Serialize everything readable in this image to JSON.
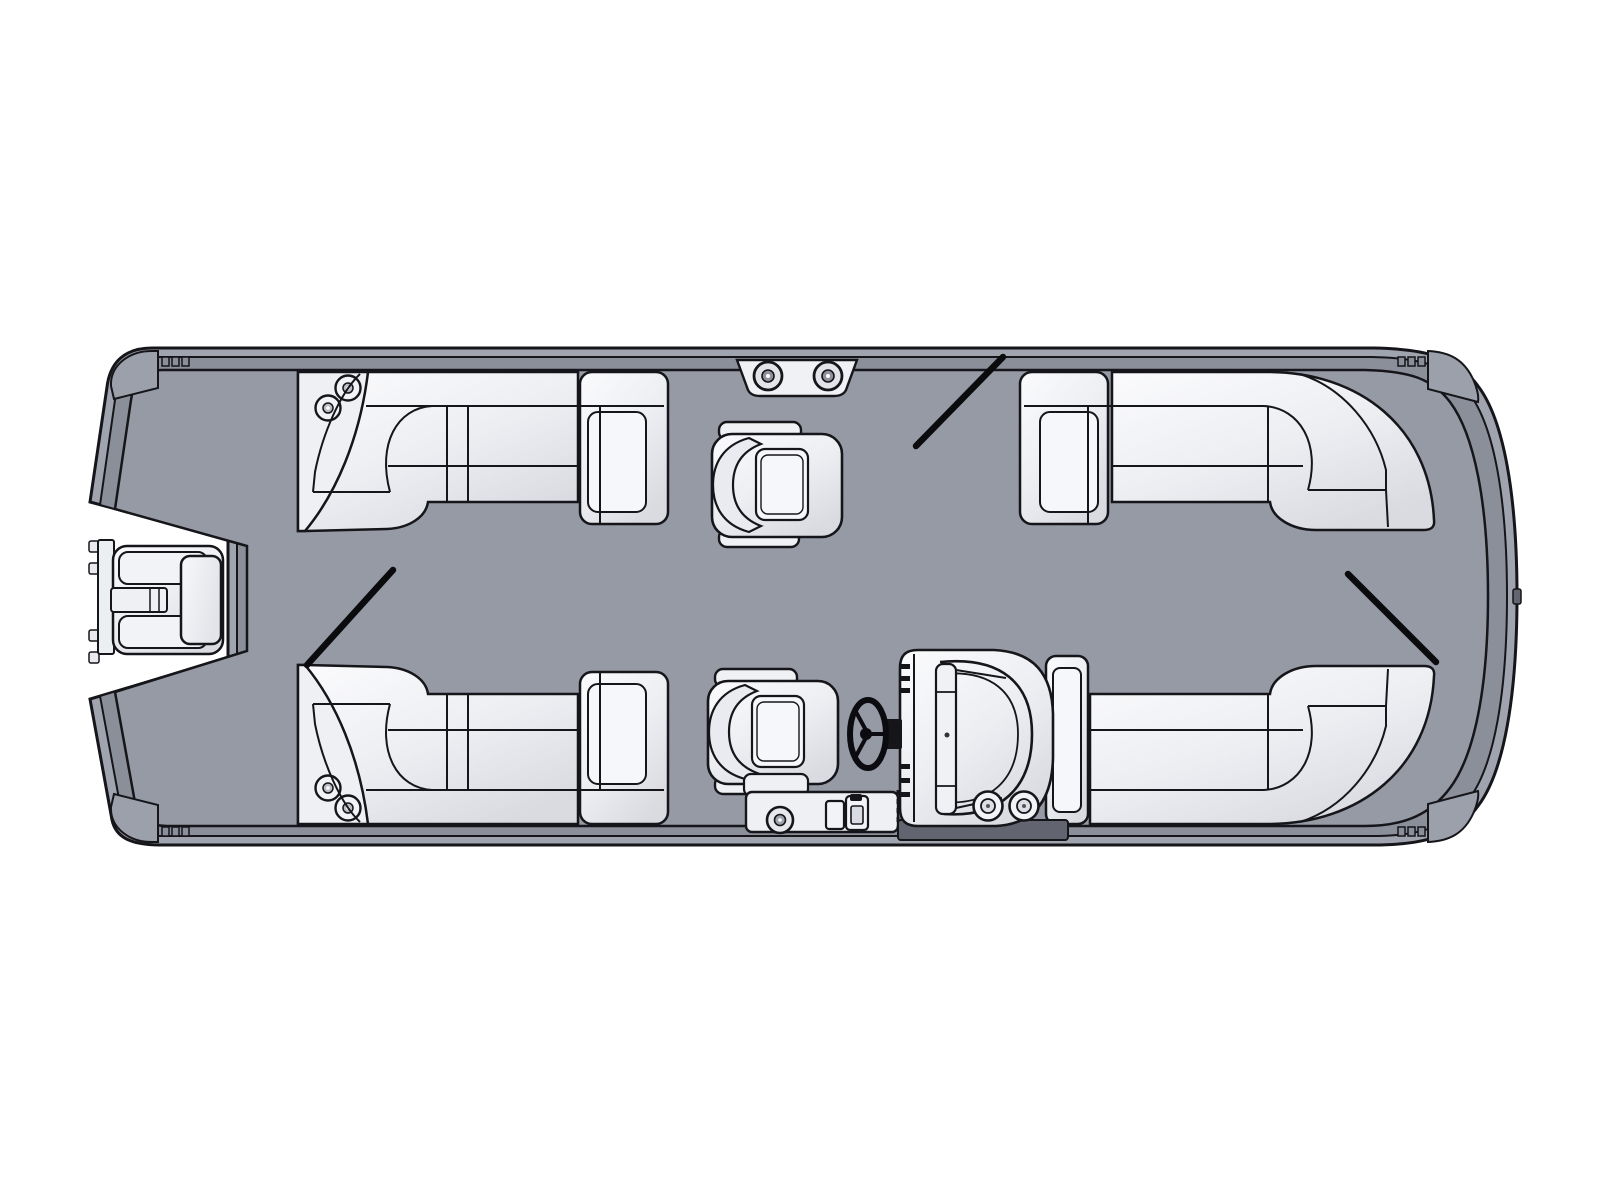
{
  "diagram": {
    "type": "pontoon-boat-floorplan-top-view",
    "orientation": "bow-right-stern-left"
  },
  "colors": {
    "background": "#ffffff",
    "hull_trim": "#a0a4ae",
    "hull_rail": "#8b8f9a",
    "deck": "#959aa5",
    "corner_cap": "#9ba0ab",
    "furniture_light": "#f2f3f6",
    "outline": "#15151a",
    "gate_line": "#0b0b0e",
    "console_base": "#62656f"
  },
  "parts": [
    {
      "name": "outboard-motor",
      "position": "stern-left"
    },
    {
      "name": "l-shaped-lounge",
      "position": "top-left"
    },
    {
      "name": "l-shaped-lounge",
      "position": "top-right"
    },
    {
      "name": "l-shaped-lounge",
      "position": "bottom-left"
    },
    {
      "name": "l-shaped-lounge",
      "position": "bottom-right"
    },
    {
      "name": "captain-chair",
      "position": "center-top"
    },
    {
      "name": "captain-chair",
      "position": "center-bottom"
    },
    {
      "name": "helm-console-with-steering-wheel",
      "position": "aft-starboard-center"
    },
    {
      "name": "boarding-step-pad",
      "position": "top-center"
    },
    {
      "name": "boarding-step-pad",
      "position": "bottom-center"
    },
    {
      "name": "gate-swing-line",
      "position": "top-center"
    },
    {
      "name": "gate-swing-line",
      "position": "mid-left"
    },
    {
      "name": "gate-swing-line",
      "position": "bow-right"
    }
  ]
}
